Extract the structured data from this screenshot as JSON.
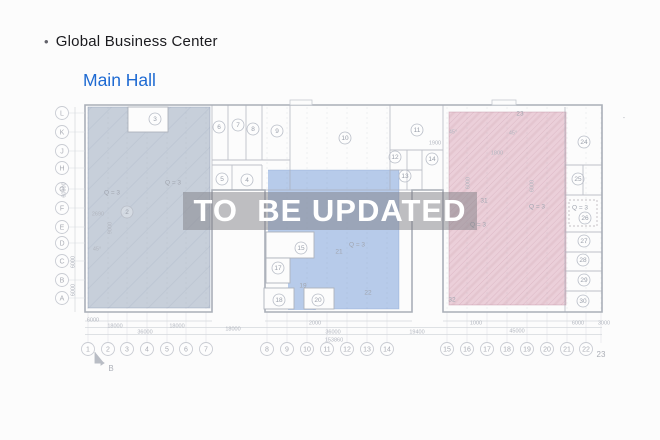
{
  "page": {
    "bullet": "•",
    "title": "Global Business Center",
    "subtitle": "Main Hall"
  },
  "watermark": {
    "text": "TO  BE UPDATED"
  },
  "colors": {
    "subtitle_blue": "#1e6ad2",
    "left_region": "#c7cfda",
    "mid_region": "#b7cbea",
    "right_region": "#ebcfd9",
    "watermark_bg": "rgba(128,128,133,0.5)",
    "watermark_text": "#ffffff"
  },
  "plan": {
    "row_axis": [
      {
        "label": "L",
        "y": 113
      },
      {
        "label": "K",
        "y": 132
      },
      {
        "label": "J",
        "y": 151
      },
      {
        "label": "H",
        "y": 168
      },
      {
        "label": "G",
        "y": 189
      },
      {
        "label": "F",
        "y": 208
      },
      {
        "label": "E",
        "y": 227
      },
      {
        "label": "D",
        "y": 243
      },
      {
        "label": "C",
        "y": 261
      },
      {
        "label": "B",
        "y": 280
      },
      {
        "label": "A",
        "y": 298
      }
    ],
    "col_axis": [
      {
        "label": "1",
        "x": 88
      },
      {
        "label": "2",
        "x": 108
      },
      {
        "label": "3",
        "x": 127
      },
      {
        "label": "4",
        "x": 147
      },
      {
        "label": "5",
        "x": 167
      },
      {
        "label": "6",
        "x": 186
      },
      {
        "label": "7",
        "x": 206
      },
      {
        "label": "8",
        "x": 267
      },
      {
        "label": "9",
        "x": 287
      },
      {
        "label": "10",
        "x": 307
      },
      {
        "label": "11",
        "x": 327
      },
      {
        "label": "12",
        "x": 347
      },
      {
        "label": "13",
        "x": 367
      },
      {
        "label": "14",
        "x": 387
      },
      {
        "label": "15",
        "x": 447
      },
      {
        "label": "16",
        "x": 467
      },
      {
        "label": "17",
        "x": 487
      },
      {
        "label": "18",
        "x": 507
      },
      {
        "label": "19",
        "x": 527
      },
      {
        "label": "20",
        "x": 547
      },
      {
        "label": "21",
        "x": 567
      },
      {
        "label": "22",
        "x": 586
      },
      {
        "label": "23",
        "x": 601,
        "plain": true
      }
    ],
    "rooms_circled": [
      {
        "label": "2",
        "x": 127,
        "y": 212
      },
      {
        "label": "3",
        "x": 155,
        "y": 119
      },
      {
        "label": "4",
        "x": 247,
        "y": 180
      },
      {
        "label": "5",
        "x": 222,
        "y": 179
      },
      {
        "label": "6",
        "x": 219,
        "y": 127
      },
      {
        "label": "7",
        "x": 238,
        "y": 125
      },
      {
        "label": "8",
        "x": 253,
        "y": 129
      },
      {
        "label": "9",
        "x": 277,
        "y": 131
      },
      {
        "label": "10",
        "x": 345,
        "y": 138
      },
      {
        "label": "11",
        "x": 417,
        "y": 130
      },
      {
        "label": "12",
        "x": 395,
        "y": 157
      },
      {
        "label": "13",
        "x": 405,
        "y": 176
      },
      {
        "label": "14",
        "x": 432,
        "y": 159
      },
      {
        "label": "15",
        "x": 301,
        "y": 248
      },
      {
        "label": "17",
        "x": 278,
        "y": 268
      },
      {
        "label": "18",
        "x": 279,
        "y": 300
      },
      {
        "label": "20",
        "x": 318,
        "y": 300
      },
      {
        "label": "24",
        "x": 584,
        "y": 142
      },
      {
        "label": "25",
        "x": 578,
        "y": 179
      },
      {
        "label": "26",
        "x": 585,
        "y": 218
      },
      {
        "label": "27",
        "x": 584,
        "y": 241
      },
      {
        "label": "28",
        "x": 583,
        "y": 260
      },
      {
        "label": "29",
        "x": 584,
        "y": 280
      },
      {
        "label": "30",
        "x": 583,
        "y": 301
      }
    ],
    "rooms_plain": [
      {
        "label": "19",
        "x": 303,
        "y": 286
      },
      {
        "label": "21",
        "x": 339,
        "y": 252
      },
      {
        "label": "22",
        "x": 368,
        "y": 293
      },
      {
        "label": "23",
        "x": 520,
        "y": 114
      },
      {
        "label": "31",
        "x": 484,
        "y": 201
      },
      {
        "label": "32",
        "x": 452,
        "y": 300
      },
      {
        "label": "Q = 3",
        "x": 112,
        "y": 193
      },
      {
        "label": "Q = 3",
        "x": 173,
        "y": 183
      },
      {
        "label": "Q = 3",
        "x": 357,
        "y": 245
      },
      {
        "label": "Q = 3",
        "x": 537,
        "y": 207
      },
      {
        "label": "Q = 3",
        "x": 478,
        "y": 225
      },
      {
        "label": "Q = 3",
        "x": 580,
        "y": 208
      },
      {
        "label": "-",
        "x": 624,
        "y": 118
      }
    ],
    "dims": [
      {
        "label": "6000",
        "x": 93,
        "y": 320
      },
      {
        "label": "18000",
        "x": 115,
        "y": 326
      },
      {
        "label": "18000",
        "x": 177,
        "y": 326
      },
      {
        "label": "36000",
        "x": 145,
        "y": 332
      },
      {
        "label": "18000",
        "x": 233,
        "y": 329
      },
      {
        "label": "2000",
        "x": 315,
        "y": 323
      },
      {
        "label": "36000",
        "x": 333,
        "y": 332
      },
      {
        "label": "153860",
        "x": 334,
        "y": 340
      },
      {
        "label": "19400",
        "x": 417,
        "y": 332
      },
      {
        "label": "1000",
        "x": 476,
        "y": 323
      },
      {
        "label": "45000",
        "x": 517,
        "y": 331
      },
      {
        "label": "6000",
        "x": 578,
        "y": 323
      },
      {
        "label": "3000",
        "x": 604,
        "y": 323
      },
      {
        "label": "2690",
        "x": 98,
        "y": 214
      },
      {
        "label": "1900",
        "x": 435,
        "y": 143
      },
      {
        "label": "1800",
        "x": 497,
        "y": 153
      },
      {
        "label": "45°",
        "x": 97,
        "y": 249
      },
      {
        "label": "45°",
        "x": 453,
        "y": 132
      },
      {
        "label": "45°",
        "x": 513,
        "y": 133
      },
      {
        "label": "60000",
        "x": 64,
        "y": 190,
        "rot": -90
      },
      {
        "label": "6000",
        "x": 73,
        "y": 262,
        "rot": -90
      },
      {
        "label": "6000",
        "x": 73,
        "y": 290,
        "rot": -90
      },
      {
        "label": "9000",
        "x": 110,
        "y": 228,
        "rot": -90
      },
      {
        "label": "6000",
        "x": 468,
        "y": 183,
        "rot": -90
      },
      {
        "label": "6000",
        "x": 532,
        "y": 186,
        "rot": -90
      }
    ],
    "marker_b": {
      "label": "B"
    }
  }
}
